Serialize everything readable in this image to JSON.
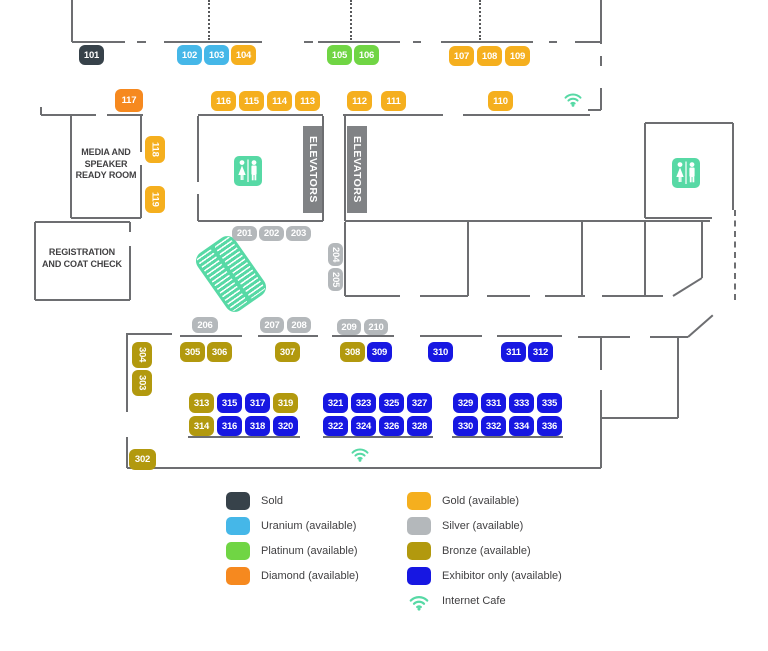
{
  "colors": {
    "sold": "#37424A",
    "uranium": "#45B7E8",
    "platinum": "#70D544",
    "diamond": "#F6891F",
    "gold": "#F5AF1E",
    "silver": "#B4B8BB",
    "bronze": "#B2990E",
    "exhibitor": "#1717E2",
    "mint": "#57D9A5",
    "wall": "#6D6E71",
    "elevator": "#808285",
    "text": "#414042"
  },
  "rooms": {
    "media": "MEDIA AND\nSPEAKER\nREADY ROOM",
    "registration": "REGISTRATION\nAND COAT CHECK",
    "elevators": "ELEVATORS"
  },
  "booths": [
    {
      "id": "101",
      "tier": "sold",
      "x": 79,
      "y": 45
    },
    {
      "id": "102",
      "tier": "uranium",
      "x": 177,
      "y": 45
    },
    {
      "id": "103",
      "tier": "uranium",
      "x": 204,
      "y": 45
    },
    {
      "id": "104",
      "tier": "gold",
      "x": 231,
      "y": 45
    },
    {
      "id": "105",
      "tier": "platinum",
      "x": 327,
      "y": 45
    },
    {
      "id": "106",
      "tier": "platinum",
      "x": 354,
      "y": 45
    },
    {
      "id": "107",
      "tier": "gold",
      "x": 449,
      "y": 46
    },
    {
      "id": "108",
      "tier": "gold",
      "x": 477,
      "y": 46
    },
    {
      "id": "109",
      "tier": "gold",
      "x": 505,
      "y": 46
    },
    {
      "id": "117",
      "tier": "diamond",
      "x": 115,
      "y": 89,
      "w": 28,
      "h": 23
    },
    {
      "id": "116",
      "tier": "gold",
      "x": 211,
      "y": 91
    },
    {
      "id": "115",
      "tier": "gold",
      "x": 239,
      "y": 91
    },
    {
      "id": "114",
      "tier": "gold",
      "x": 267,
      "y": 91
    },
    {
      "id": "113",
      "tier": "gold",
      "x": 295,
      "y": 91
    },
    {
      "id": "112",
      "tier": "gold",
      "x": 347,
      "y": 91
    },
    {
      "id": "111",
      "tier": "gold",
      "x": 381,
      "y": 91
    },
    {
      "id": "110",
      "tier": "gold",
      "x": 488,
      "y": 91
    },
    {
      "id": "118",
      "tier": "gold",
      "x": 145,
      "y": 136,
      "w": 20,
      "h": 27,
      "v": true
    },
    {
      "id": "119",
      "tier": "gold",
      "x": 145,
      "y": 186,
      "w": 20,
      "h": 27,
      "v": true
    },
    {
      "id": "201",
      "tier": "silver",
      "x": 232,
      "y": 226,
      "w": 25,
      "h": 15
    },
    {
      "id": "202",
      "tier": "silver",
      "x": 259,
      "y": 226,
      "w": 25,
      "h": 15
    },
    {
      "id": "203",
      "tier": "silver",
      "x": 286,
      "y": 226,
      "w": 25,
      "h": 15
    },
    {
      "id": "204",
      "tier": "silver",
      "x": 328,
      "y": 243,
      "w": 15,
      "h": 23,
      "v": true
    },
    {
      "id": "205",
      "tier": "silver",
      "x": 328,
      "y": 268,
      "w": 15,
      "h": 23,
      "v": true
    },
    {
      "id": "206",
      "tier": "silver",
      "x": 192,
      "y": 317,
      "w": 26,
      "h": 16
    },
    {
      "id": "207",
      "tier": "silver",
      "x": 260,
      "y": 317,
      "w": 24,
      "h": 16
    },
    {
      "id": "208",
      "tier": "silver",
      "x": 287,
      "y": 317,
      "w": 24,
      "h": 16
    },
    {
      "id": "209",
      "tier": "silver",
      "x": 337,
      "y": 319,
      "w": 24,
      "h": 16
    },
    {
      "id": "210",
      "tier": "silver",
      "x": 364,
      "y": 319,
      "w": 24,
      "h": 16
    },
    {
      "id": "304",
      "tier": "bronze",
      "x": 132,
      "y": 342,
      "w": 20,
      "h": 26,
      "v": true
    },
    {
      "id": "303",
      "tier": "bronze",
      "x": 132,
      "y": 370,
      "w": 20,
      "h": 26,
      "v": true
    },
    {
      "id": "302",
      "tier": "bronze",
      "x": 129,
      "y": 449,
      "w": 27,
      "h": 21
    },
    {
      "id": "305",
      "tier": "bronze",
      "x": 180,
      "y": 342
    },
    {
      "id": "306",
      "tier": "bronze",
      "x": 207,
      "y": 342
    },
    {
      "id": "307",
      "tier": "bronze",
      "x": 275,
      "y": 342
    },
    {
      "id": "308",
      "tier": "bronze",
      "x": 340,
      "y": 342
    },
    {
      "id": "309",
      "tier": "exhibitor",
      "x": 367,
      "y": 342
    },
    {
      "id": "310",
      "tier": "exhibitor",
      "x": 428,
      "y": 342
    },
    {
      "id": "311",
      "tier": "exhibitor",
      "x": 501,
      "y": 342
    },
    {
      "id": "312",
      "tier": "exhibitor",
      "x": 528,
      "y": 342
    },
    {
      "id": "313",
      "tier": "bronze",
      "x": 189,
      "y": 393
    },
    {
      "id": "315",
      "tier": "exhibitor",
      "x": 217,
      "y": 393
    },
    {
      "id": "317",
      "tier": "exhibitor",
      "x": 245,
      "y": 393
    },
    {
      "id": "319",
      "tier": "bronze",
      "x": 273,
      "y": 393
    },
    {
      "id": "321",
      "tier": "exhibitor",
      "x": 323,
      "y": 393
    },
    {
      "id": "323",
      "tier": "exhibitor",
      "x": 351,
      "y": 393
    },
    {
      "id": "325",
      "tier": "exhibitor",
      "x": 379,
      "y": 393
    },
    {
      "id": "327",
      "tier": "exhibitor",
      "x": 407,
      "y": 393
    },
    {
      "id": "329",
      "tier": "exhibitor",
      "x": 453,
      "y": 393
    },
    {
      "id": "331",
      "tier": "exhibitor",
      "x": 481,
      "y": 393
    },
    {
      "id": "333",
      "tier": "exhibitor",
      "x": 509,
      "y": 393
    },
    {
      "id": "335",
      "tier": "exhibitor",
      "x": 537,
      "y": 393
    },
    {
      "id": "314",
      "tier": "bronze",
      "x": 189,
      "y": 416
    },
    {
      "id": "316",
      "tier": "exhibitor",
      "x": 217,
      "y": 416
    },
    {
      "id": "318",
      "tier": "exhibitor",
      "x": 245,
      "y": 416
    },
    {
      "id": "320",
      "tier": "exhibitor",
      "x": 273,
      "y": 416
    },
    {
      "id": "322",
      "tier": "exhibitor",
      "x": 323,
      "y": 416
    },
    {
      "id": "324",
      "tier": "exhibitor",
      "x": 351,
      "y": 416
    },
    {
      "id": "326",
      "tier": "exhibitor",
      "x": 379,
      "y": 416
    },
    {
      "id": "328",
      "tier": "exhibitor",
      "x": 407,
      "y": 416
    },
    {
      "id": "330",
      "tier": "exhibitor",
      "x": 453,
      "y": 416
    },
    {
      "id": "332",
      "tier": "exhibitor",
      "x": 481,
      "y": 416
    },
    {
      "id": "334",
      "tier": "exhibitor",
      "x": 509,
      "y": 416
    },
    {
      "id": "336",
      "tier": "exhibitor",
      "x": 537,
      "y": 416
    }
  ],
  "legend": {
    "left": [
      {
        "label": "Sold",
        "tier": "sold"
      },
      {
        "label": "Uranium (available)",
        "tier": "uranium"
      },
      {
        "label": "Platinum (available)",
        "tier": "platinum"
      },
      {
        "label": "Diamond (available)",
        "tier": "diamond"
      }
    ],
    "right": [
      {
        "label": "Gold (available)",
        "tier": "gold"
      },
      {
        "label": "Silver (available)",
        "tier": "silver"
      },
      {
        "label": "Bronze (available)",
        "tier": "bronze"
      },
      {
        "label": "Exhibitor only (available)",
        "tier": "exhibitor"
      },
      {
        "label": "Internet Cafe",
        "tier": "wifi"
      }
    ]
  }
}
